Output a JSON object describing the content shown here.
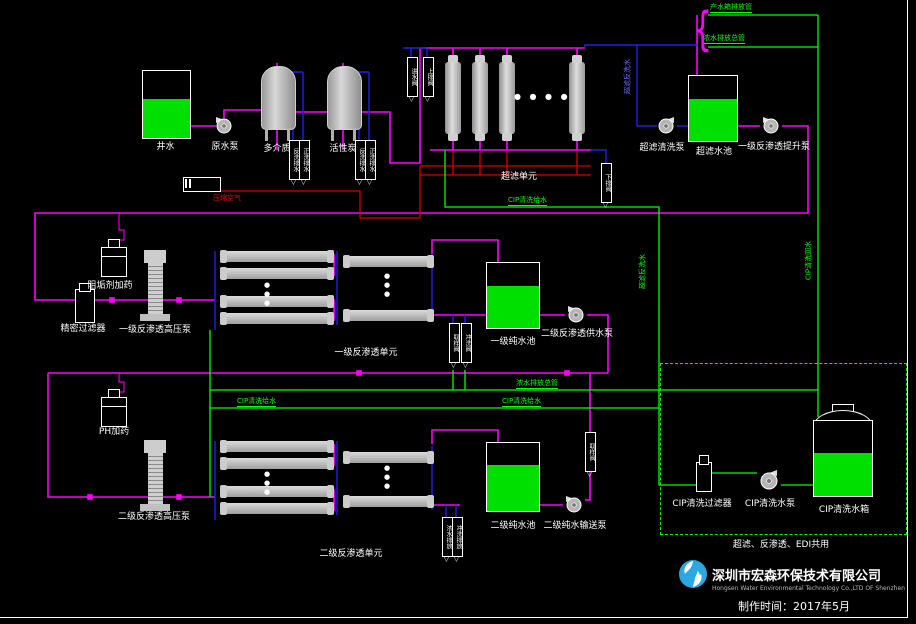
{
  "labels": {
    "well_water": "井水",
    "raw_pump": "原水泵",
    "mm_filter": "多介质",
    "ac_filter": "活性炭",
    "compressed_air": "压缩空气",
    "uf_unit": "超滤单元",
    "uf_clean_pump": "超滤清洗泵",
    "uf_tank": "超滤水池",
    "ro1_lift_pump": "一级反渗透提升泵",
    "product_drain": "产水箱排放管",
    "conc_drain": "浓水排放总管",
    "uf_backwash": "超滤反洗水",
    "cip_return": "CIP清洗回水",
    "cip_feed": "CIP清洗给水",
    "antiscalant": "阻垢剂加药",
    "cartridge_filter": "精密过滤器",
    "ro1_hp_pump": "一级反渗透高压泵",
    "ro1_unit": "一级反渗透单元",
    "ro1_tank": "一级纯水池",
    "ro2_feed_pump": "二级反渗透供水泵",
    "ph_dosing": "PH加药",
    "ro2_hp_pump": "二级反渗透高压泵",
    "ro2_unit": "二级反渗透单元",
    "ro2_tank": "二级纯水池",
    "ro2_transfer_pump": "二级纯水输送泵",
    "cip_filter": "CIP清洗过滤器",
    "cip_pump": "CIP清洗水泵",
    "cip_tank": "CIP清洗水箱",
    "cip_shared": "超滤、反渗透、EDI共用"
  },
  "valves": {
    "inlet": "进水阀",
    "top_drain": "上排阀",
    "bottom_drain": "下排阀",
    "backwash": "反洗排水",
    "rinse": "正洗排水",
    "sample": "取样阀",
    "flush": "冲洗阀",
    "conc_drain": "浓水排放",
    "flush_drain": "冲洗排放"
  },
  "footer": {
    "company_cn": "深圳市宏森环保技术有限公司",
    "company_en": "Hongsen Water Environmental Technology Co.,LTD OF Shenzhen",
    "made": "制作时间：2017年5月"
  },
  "misc": {
    "dots_row": "● ● ● ●",
    "dots_col": "●●●",
    "arrow_down": "▽",
    "brace": "{"
  },
  "colors": {
    "feed_pipe": "#ff00ff",
    "permeate_pipe": "#2020e8",
    "drain_air_pipe": "#d40000",
    "cip_pipe": "#00ff00",
    "tank_fill": "#00e000",
    "logo_blue": "#2ba7e2"
  }
}
